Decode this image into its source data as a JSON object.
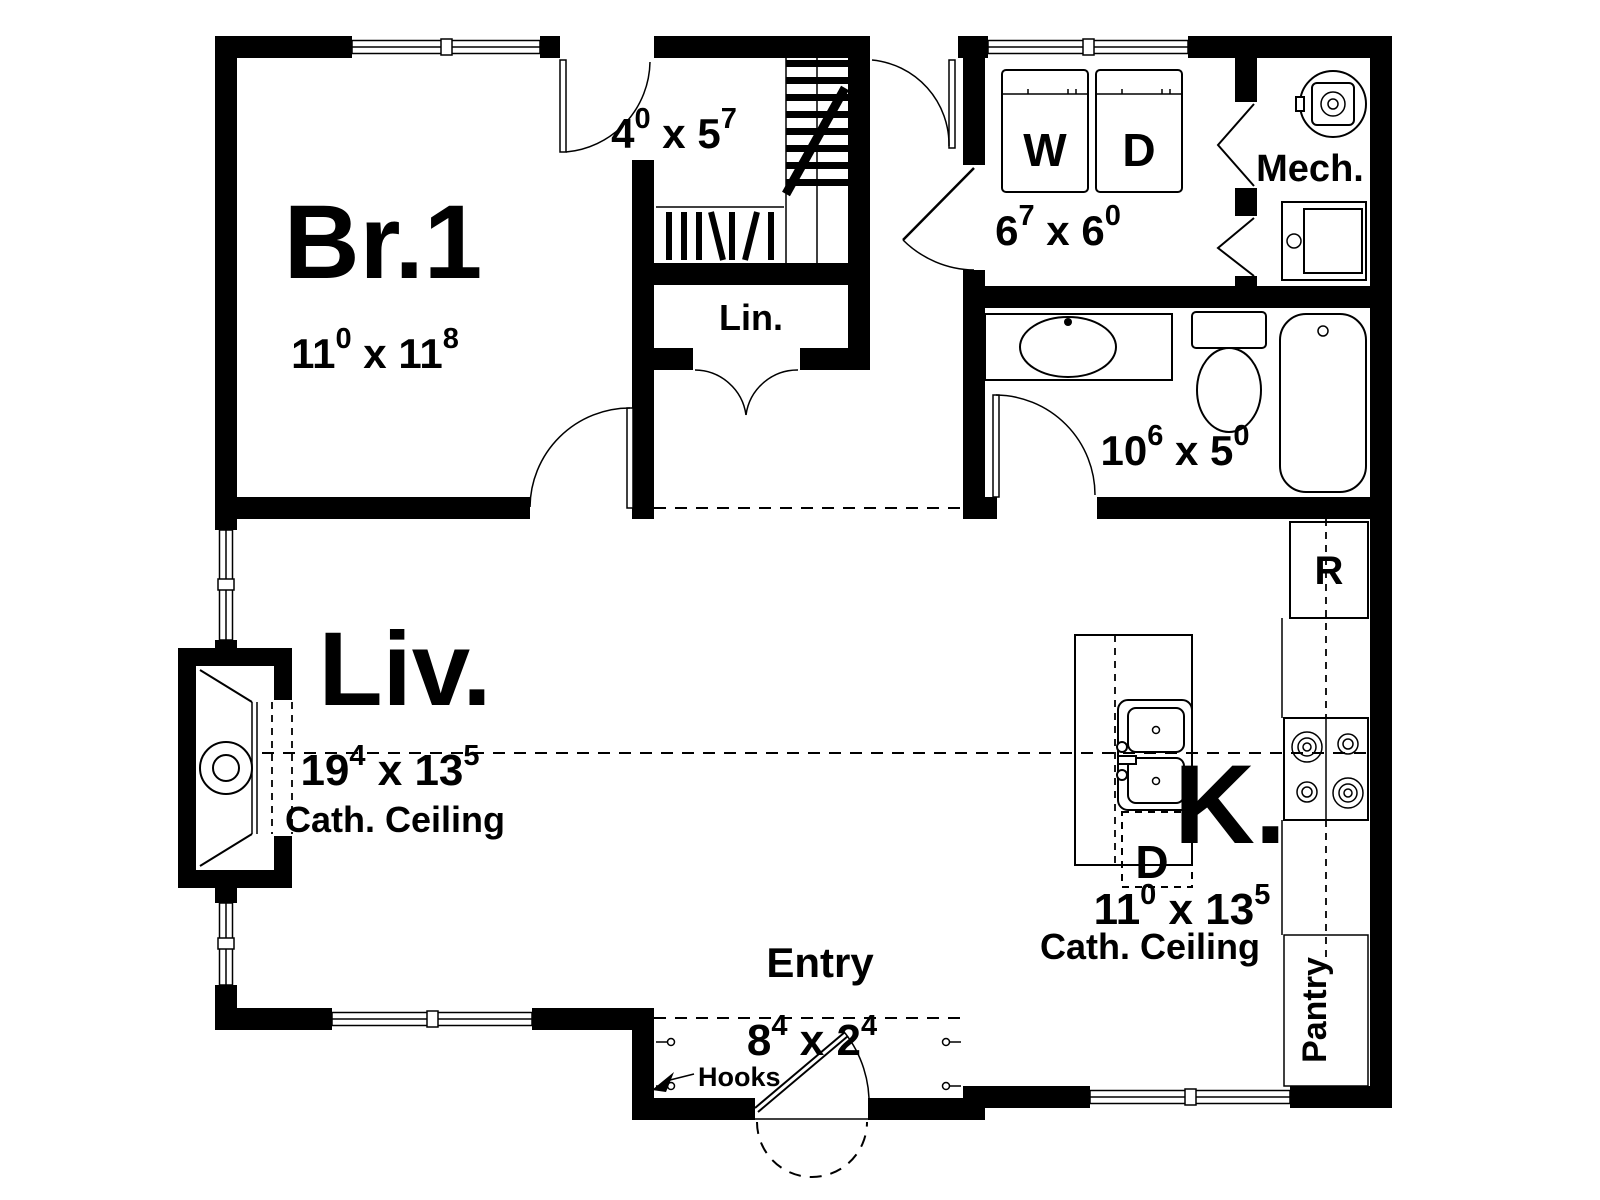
{
  "dim_sep": " x ",
  "rooms": {
    "bedroom": {
      "name": "Br.1",
      "w_ft": "11",
      "w_in": "0",
      "l_ft": "11",
      "l_in": "8"
    },
    "closet": {
      "w_ft": "4",
      "w_in": "0",
      "l_ft": "5",
      "l_in": "7"
    },
    "linen": {
      "name": "Lin."
    },
    "laundry": {
      "w_ft": "6",
      "w_in": "7",
      "l_ft": "6",
      "l_in": "0"
    },
    "mechanical": {
      "name": "Mech."
    },
    "bathroom": {
      "w_ft": "10",
      "w_in": "6",
      "l_ft": "5",
      "l_in": "0"
    },
    "living": {
      "name": "Liv.",
      "w_ft": "19",
      "w_in": "4",
      "l_ft": "13",
      "l_in": "5",
      "ceiling": "Cath. Ceiling"
    },
    "kitchen": {
      "name": "K.",
      "w_ft": "11",
      "w_in": "0",
      "l_ft": "13",
      "l_in": "5",
      "ceiling": "Cath. Ceiling"
    },
    "entry": {
      "name": "Entry",
      "w_ft": "8",
      "w_in": "4",
      "l_ft": "2",
      "l_in": "4",
      "note": "Hooks"
    }
  },
  "appliances": {
    "washer": "W",
    "dryer": "D",
    "refrigerator": "R",
    "dishwasher": "D",
    "pantry": "Pantry"
  },
  "colors": {
    "wall": "#000000",
    "background": "#ffffff"
  }
}
